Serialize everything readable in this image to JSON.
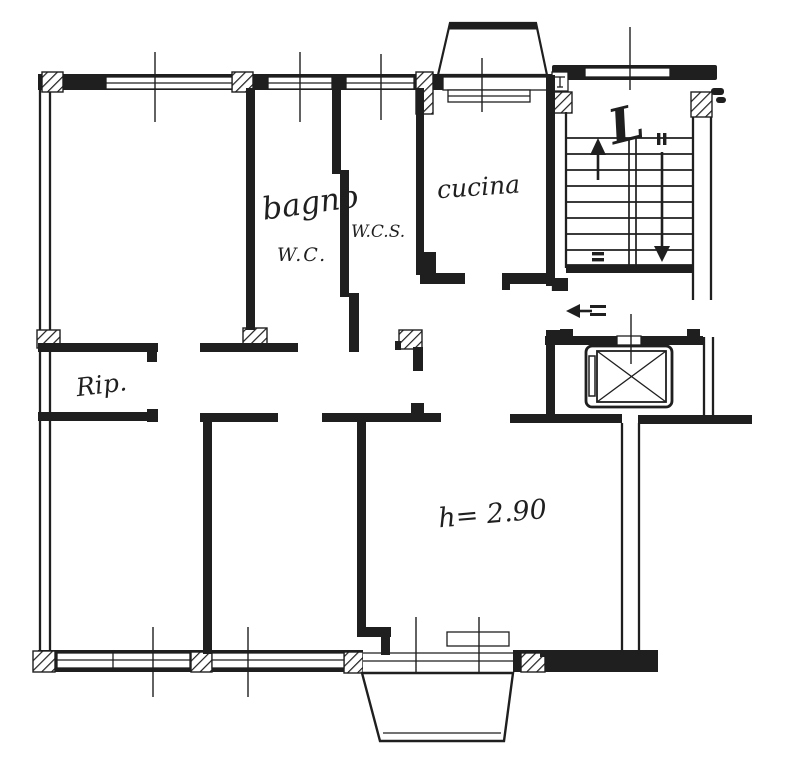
{
  "document": {
    "kind": "scanned floor plan",
    "colors": {
      "paper": "#ffffff",
      "ink": "#1f1f1f"
    }
  },
  "labels": {
    "bathroom": "bagno",
    "bathroom_wc": "W.C.",
    "service_wc": "W.C.S.",
    "kitchen": "cucina",
    "storage": "Rip.",
    "stair_landing": "L",
    "ceiling_height": "h= 2.90"
  },
  "icons": {
    "stair_up_arrow": "↑",
    "stair_down_arrow": "↓",
    "entrance_arrow": "←",
    "elevator_symbol": "⊠"
  }
}
